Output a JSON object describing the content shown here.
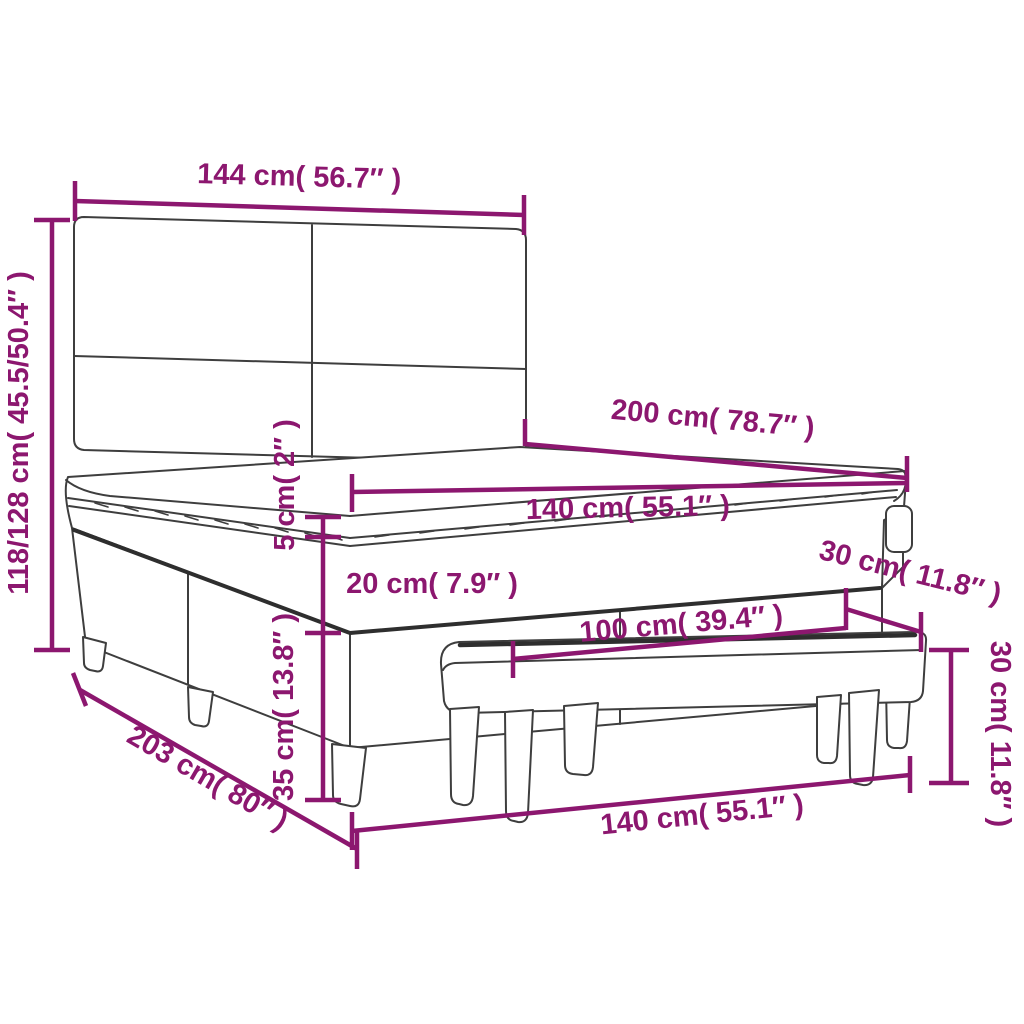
{
  "diagram": {
    "type": "product-dimension-diagram",
    "subject": "box spring bed with headboard, mattress topper and bench",
    "colors": {
      "dimension": "#8C176F",
      "outline": "#3E3E3E",
      "outline_dark": "#2E2E2E",
      "background": "#FFFFFF"
    },
    "labels": {
      "headboard_width": "144 cm( 56.7″ )",
      "bed_height": "118/128 cm( 45.5/50.4″ )",
      "bed_length": "200 cm( 78.7″ )",
      "mattress_width": "140 cm( 55.1″ )",
      "topper_thickness": "5 cm( 2″ )",
      "mattress_thickness": "20 cm( 7.9″ )",
      "base_height": "35 cm( 13.8″ )",
      "bench_depth": "30 cm( 11.8″ )",
      "bench_length": "100 cm( 39.4″ )",
      "bench_height": "30 cm( 11.8″ )",
      "base_length": "203 cm( 80″ )",
      "bed_width": "140 cm( 55.1″ )"
    }
  }
}
